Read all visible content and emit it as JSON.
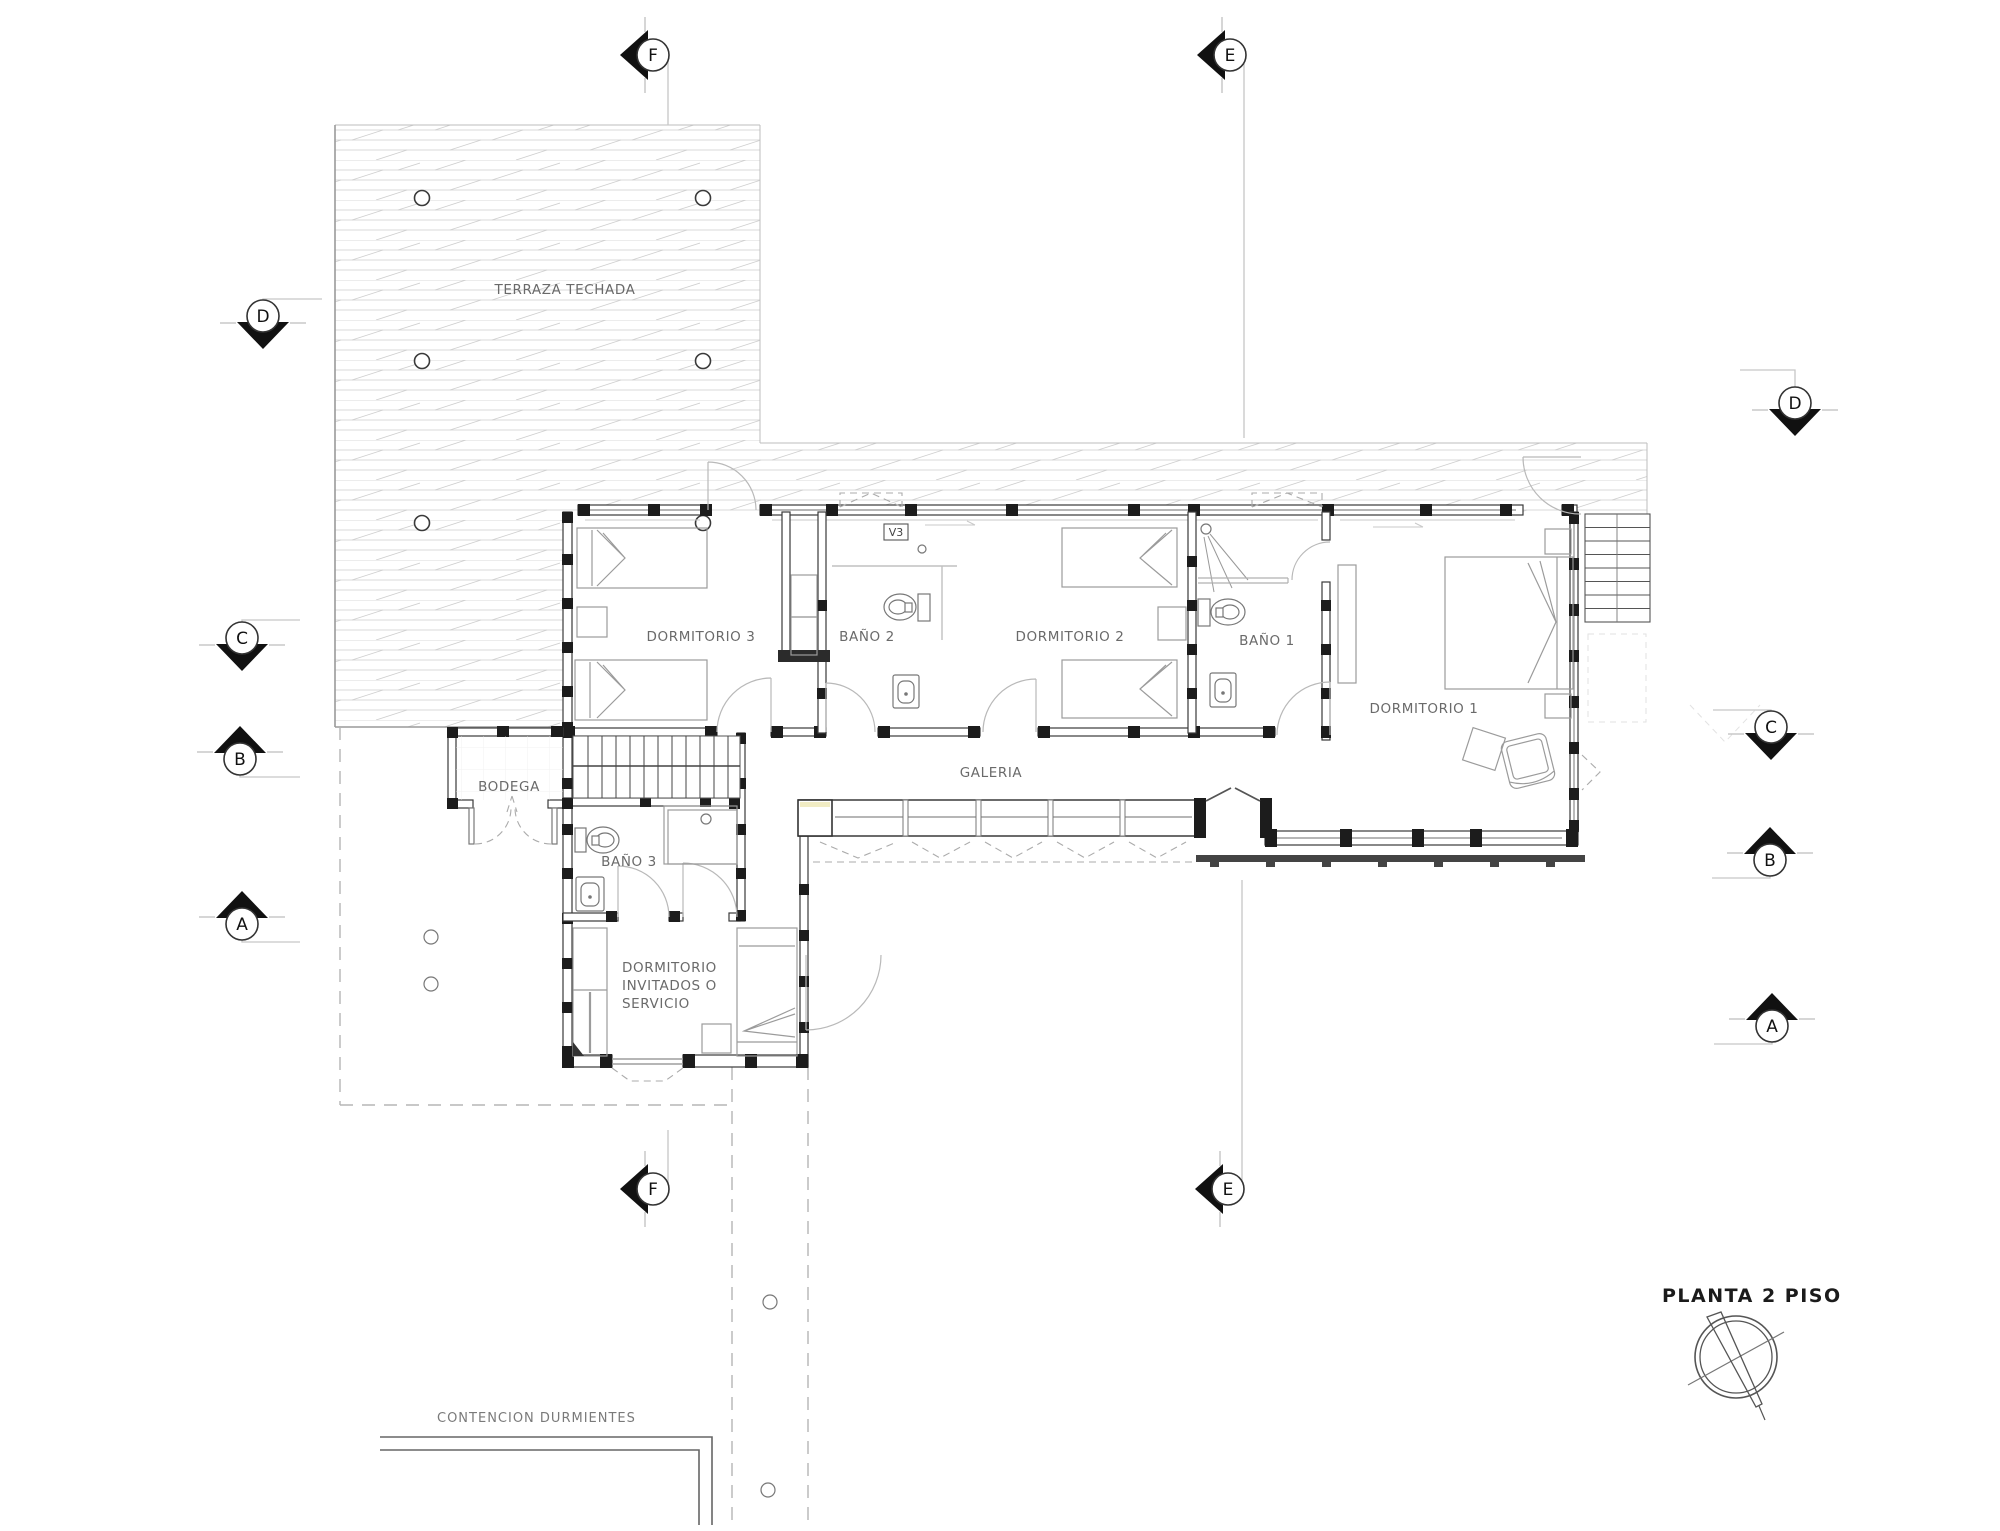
{
  "title": {
    "label": "PLANTA  2 PISO"
  },
  "plan": {
    "terrace_label": "TERRAZA TECHADA",
    "rooms": {
      "dormitorio3": "DORMITORIO 3",
      "bano2": "BAÑO 2",
      "dormitorio2": "DORMITORIO 2",
      "bano1": "BAÑO 1",
      "dormitorio1": "DORMITORIO 1",
      "galeria": "GALERIA",
      "bodega": "BODEGA",
      "bano3": "BAÑO 3",
      "invitados_line1": "DORMITORIO",
      "invitados_line2": "INVITADOS O",
      "invitados_line3": "SERVICIO"
    },
    "window_tag": "V3",
    "site_note": "CONTENCION DURMIENTES"
  },
  "markers": {
    "top_f": "F",
    "top_e": "E",
    "left_d": "D",
    "left_c": "C",
    "left_b": "B",
    "left_a": "A",
    "right_d": "D",
    "right_c": "C",
    "right_b": "B",
    "right_a": "A",
    "bottom_f": "F",
    "bottom_e": "E"
  },
  "colors": {
    "wall": "#3a3a3a",
    "post": "#1c1c1c",
    "furniture": "#9b9b9b",
    "label_text": "#6a6a6a",
    "marker_fill": "#111111",
    "deck_hatch": "#d6d6d6",
    "dashed_site": "#b5b5b5",
    "background": "#ffffff"
  }
}
